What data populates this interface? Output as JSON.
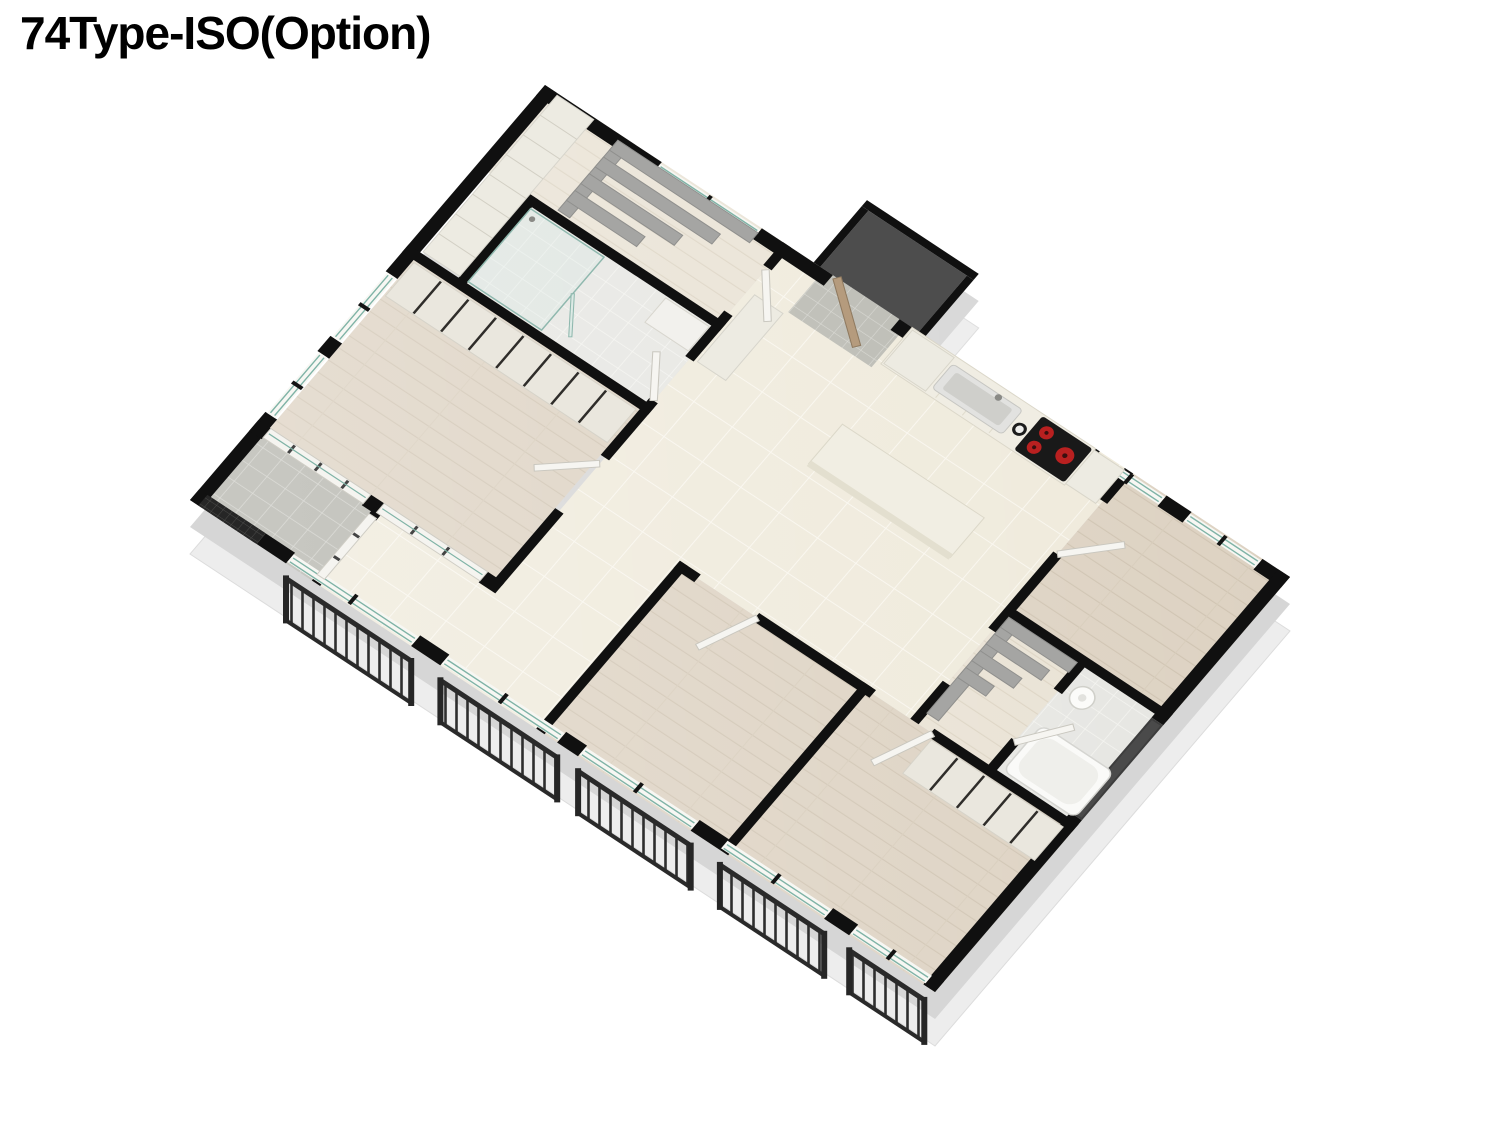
{
  "title": "74Type-ISO(Option)",
  "floorplan": {
    "view": "isometric-3d-floor-plan",
    "unit_type": "74Type",
    "variant": "ISO(Option)",
    "rooms": [
      "entrance-porch",
      "entrance-hall",
      "dressing-room-a",
      "shower-bathroom",
      "master-bedroom",
      "kitchen",
      "living-dining",
      "small-bedroom-top-right",
      "walk-in-closet-b",
      "main-bathroom",
      "bedroom-bottom-center",
      "bedroom-bottom-right",
      "utility-balcony"
    ],
    "fixtures": [
      "kitchen-sink",
      "cooktop",
      "kitchen-island",
      "wardrobes",
      "stepped-shelving",
      "bathtub",
      "washbasin",
      "shower-glass",
      "balcony-railings",
      "glass-balustrades",
      "mesh-screen",
      "doors"
    ]
  },
  "colors": {
    "background": "#ffffff",
    "wall_cut": "#101010",
    "wall_face": "#d6d6d6",
    "base_slab": "#ededed",
    "tile_floor": "#efeadb",
    "wood_floor": "#ddd2c2",
    "gray_tile": "#b4b4ac",
    "cabinet": "#edebe2",
    "shelf_gray": "#a5a5a3",
    "glass": "#7fb3a6",
    "railing": "#2d2d2d",
    "burner_red": "#b92020",
    "porch_floor": "#4d4d4d",
    "dark_window": "#3d3d3d"
  }
}
